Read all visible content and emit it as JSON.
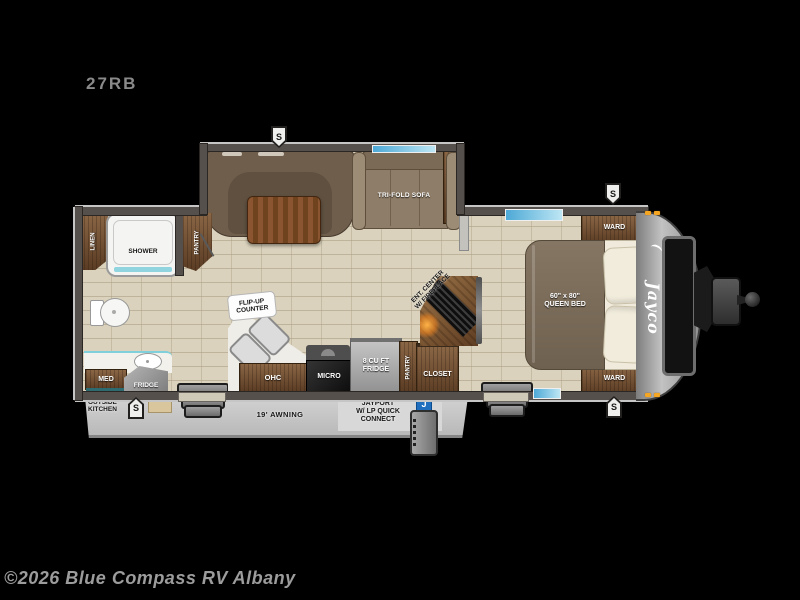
{
  "page": {
    "model_number": "27RB",
    "watermark": "©2026 Blue Compass RV Albany"
  },
  "exterior": {
    "brand_logo": "Jayco",
    "awning_label": "19' AWNING",
    "jayport_label": [
      "JAYPORT",
      "W/ LP QUICK",
      "CONNECT"
    ],
    "jayport_badge": "J",
    "outside_kitchen_label": [
      "OUTSIDE",
      "KITCHEN"
    ],
    "speaker_symbol": "S"
  },
  "living_area": {
    "sofa_label": "TRI-FOLD SOFA",
    "ent_center_label": [
      "ENT. CENTER",
      "W/ FIREPLACE"
    ],
    "flip_up_counter_label": [
      "FLIP-UP",
      "COUNTER"
    ]
  },
  "kitchen": {
    "ohc_label": "OHC",
    "micro_label": "MICRO",
    "fridge_label": [
      "8 CU FT",
      "FRIDGE"
    ],
    "pantry_label": "PANTRY",
    "closet_label": "CLOSET"
  },
  "bathroom": {
    "linen_label": "LINEN",
    "shower_label": "SHOWER",
    "pantry_label": "PANTRY",
    "med_label": "MED",
    "fridge_label": "FRIDGE"
  },
  "bedroom": {
    "ward_top_label": "WARD",
    "ward_bottom_label": "WARD",
    "bed_label": [
      "60\" x 80\"",
      "QUEEN BED"
    ]
  },
  "colors": {
    "background": "#000000",
    "floor_tile": "#dad2bc",
    "wall": "#55504b",
    "wood_dark": "#5a3c24",
    "wood_light": "#8a6645",
    "window_blue": "#7ec8e8",
    "marker_amber": "#f5a623",
    "jayport_blue": "#1f6fbe",
    "fireplace_glow": "#ff9c2e",
    "watermark_gray": "#9c9c9c"
  }
}
